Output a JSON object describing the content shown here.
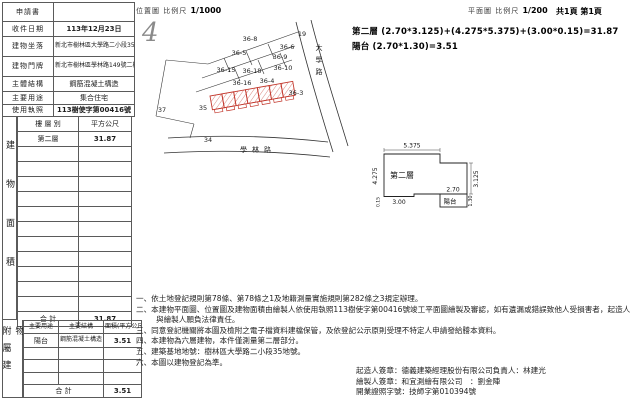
{
  "header": {
    "location_label": "位置圖 比例尺",
    "location_scale": "1/1000",
    "plan_label": "平面圖 比例尺",
    "plan_scale": "1/200",
    "page_info": "共1頁 第1頁"
  },
  "stamp_mark": "4",
  "colors": {
    "building_outline": "#c3392e",
    "line": "#333333"
  },
  "info_table": {
    "rows": [
      {
        "label": "申請書",
        "value": ""
      },
      {
        "label": "收件日期",
        "value": "113年12月23日"
      },
      {
        "label": "建物坐落",
        "value": "新北市樹林區大學路二小段35地號"
      },
      {
        "label": "建物門牌",
        "value": "新北市樹林區學林路149號二樓"
      },
      {
        "label": "主體結構",
        "value": "鋼筋混凝土構造"
      },
      {
        "label": "主要用途",
        "value": "集合住宅"
      },
      {
        "label": "使用執照",
        "value": "113樹使字第00416號"
      }
    ]
  },
  "area_table": {
    "side_label": "建物面積",
    "col_floor": "樓 層 別",
    "col_area": "平方公尺",
    "floor": "第二層",
    "floor_area": "31.87",
    "total_label": "合 計",
    "total": "31.87"
  },
  "annex_table": {
    "side_label": "附屬建物",
    "col_use": "主要用途",
    "col_structure": "主要結構",
    "col_area": "面積(平方公尺)",
    "use": "陽台",
    "structure": "鋼筋混凝土構造",
    "area": "3.51",
    "total_label": "合 計",
    "total": "3.51"
  },
  "map": {
    "lots": [
      "19",
      "36-8",
      "36-6",
      "36-5",
      "36-9",
      "36-15",
      "36-18",
      "36-10",
      "36-16",
      "36-4",
      "36-3",
      "35",
      "37",
      "34"
    ],
    "road_vertical": "大學路",
    "road_bottom": "學林路"
  },
  "formula": {
    "line1": "第二層 (2.70*3.125)+(4.275*5.375)+(3.00*0.15)=31.87",
    "line2": "陽台 (2.70*1.30)=3.51"
  },
  "plan": {
    "floor_label": "第二層",
    "balcony_label": "陽台",
    "dims": {
      "width_top": "5.375",
      "height_left": "4.275",
      "height_right": "3.125",
      "width_inner": "2.70",
      "width_bottom": "3.00",
      "strip": "0.15",
      "balcony_height": "1.30"
    }
  },
  "notes": [
    "一、依土地登記規則第78條、第78條之1及地籍測量實施規則第282條之3規定辦理。",
    "二、本建物平面圖、位置圖及建物面積由繪製人依使用執照113樹使字第00416號竣工平面圖繪製及審認，如有遺漏或錯誤致他人受損害者，起造人與繪製人願負法律責任。",
    "三、同意登記機關將本圖及檢附之電子檔資料建檔保管，及依登記公示原則受理不特定人申請發給謄本資料。",
    "四、本建物為六層建物，本件僅測量第二層部分。",
    "五、建築基地地號：樹林區大學路二小段35地號。",
    "六、本圖以建物登記為準。"
  ],
  "footer": {
    "builder": "起造人簽章：德義建築經理股份有限公司負責人：林建光",
    "drafter": "繪製人簽章：和宜測繪有限公司　：劉金陣",
    "license": "開業證照字號：技師字第010394號"
  }
}
